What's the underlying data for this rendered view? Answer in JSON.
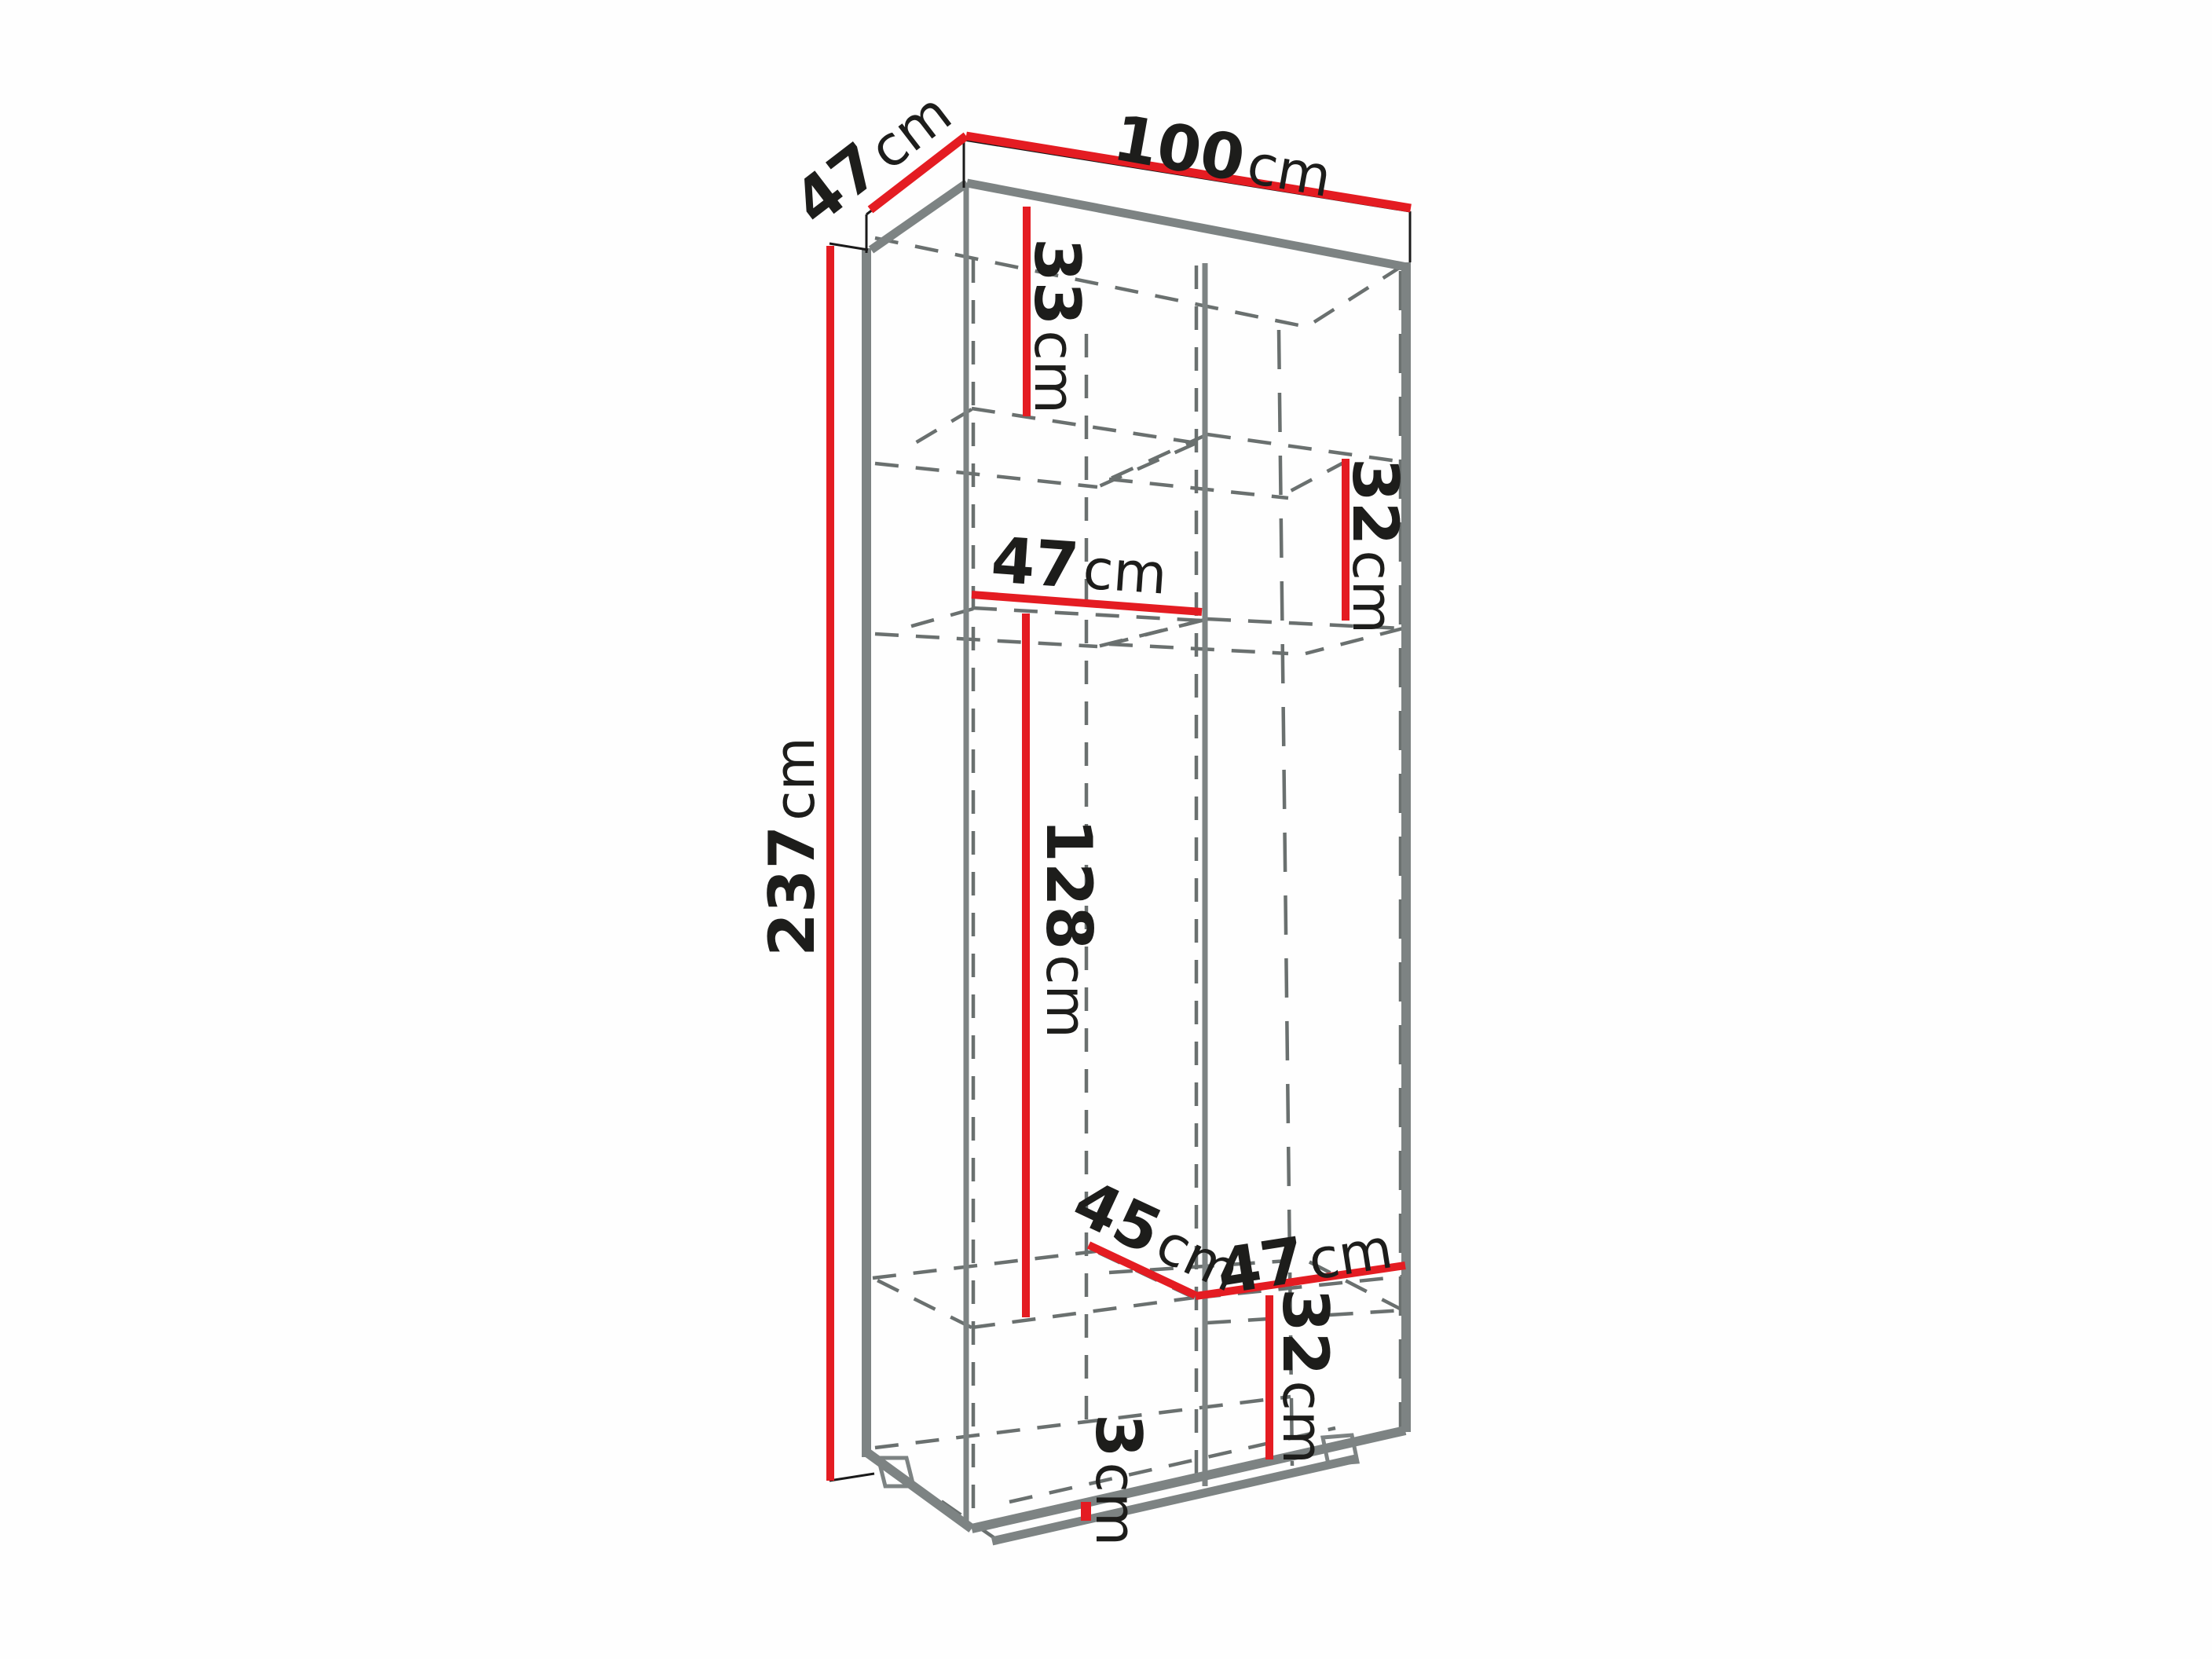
{
  "diagram": {
    "type": "furniture-dimension-drawing",
    "subject": "tall two-column wardrobe shown in perspective with red dimension lines",
    "unit": "cm",
    "colors": {
      "dimension_line": "#e41c22",
      "edge_gray": "#7d8383",
      "outline_black": "#1a1a1a",
      "hidden_line": "#6a706f",
      "text": "#1d1d1b",
      "background": "#fefefe"
    },
    "labels": {
      "depth_top": {
        "value": "47",
        "unit": "cm"
      },
      "width_top": {
        "value": "100",
        "unit": "cm"
      },
      "height_left": {
        "value": "237",
        "unit": "cm"
      },
      "top_shelf_left": {
        "value": "33",
        "unit": "cm"
      },
      "upper_shelf_right": {
        "value": "32",
        "unit": "cm"
      },
      "inner_width_left": {
        "value": "47",
        "unit": "cm"
      },
      "hanging_height": {
        "value": "128",
        "unit": "cm"
      },
      "bottom_depth": {
        "value": "45",
        "unit": "cm"
      },
      "inner_width_right": {
        "value": "47",
        "unit": "cm"
      },
      "bottom_shelf_right": {
        "value": "32",
        "unit": "cm"
      },
      "plinth_height": {
        "value": "3",
        "unit": "cm"
      }
    }
  }
}
